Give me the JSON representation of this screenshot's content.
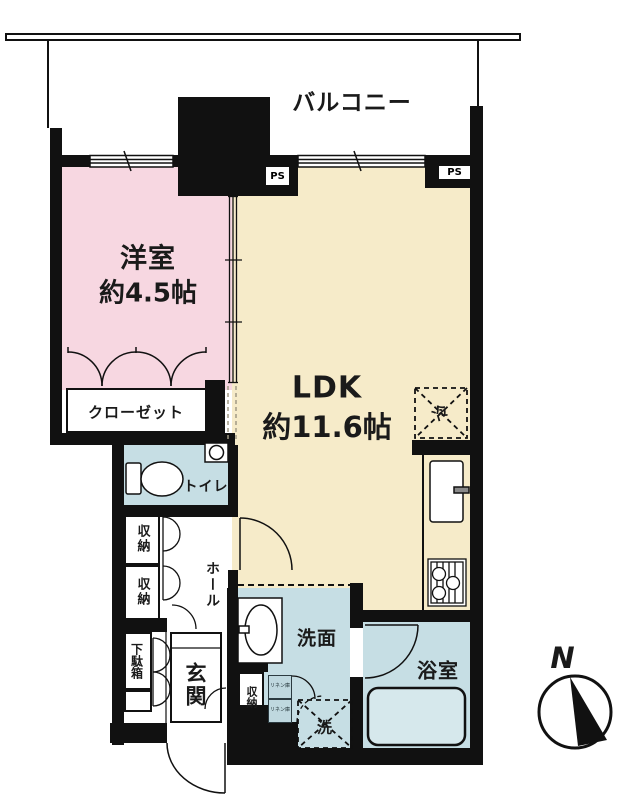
{
  "plan": {
    "balcony": {
      "label": "バルコニー"
    },
    "western_room": {
      "name": "洋室",
      "size": "約4.5帖"
    },
    "ldk": {
      "name": "LDK",
      "size": "約11.6帖"
    },
    "closet": {
      "label": "クローゼット"
    },
    "toilet": {
      "label": "トイレ"
    },
    "hall": {
      "label": "ホール"
    },
    "storage_upper": {
      "label": "収納"
    },
    "storage_lower": {
      "label": "収納"
    },
    "shoe_cabinet": {
      "label": "下駄箱"
    },
    "entrance": {
      "label": "玄関"
    },
    "entrance_storage": {
      "label": "収納"
    },
    "washroom": {
      "label": "洗面"
    },
    "washing_machine": {
      "label": "洗"
    },
    "bathroom": {
      "label": "浴室"
    },
    "refrigerator": {
      "label": "冷"
    },
    "pipe_space_left": {
      "label": "PS"
    },
    "pipe_space_right": {
      "label": "PS"
    },
    "linen_upper": {
      "label": "リネン庫"
    },
    "linen_lower": {
      "label": "リネン庫"
    },
    "compass": {
      "label": "N"
    }
  },
  "colors": {
    "western_room": "#f7d7e1",
    "ldk": "#f6ebc9",
    "wet_area": "#c6dee4",
    "wall": "#111111",
    "bathtub": "#d6e8ec"
  }
}
